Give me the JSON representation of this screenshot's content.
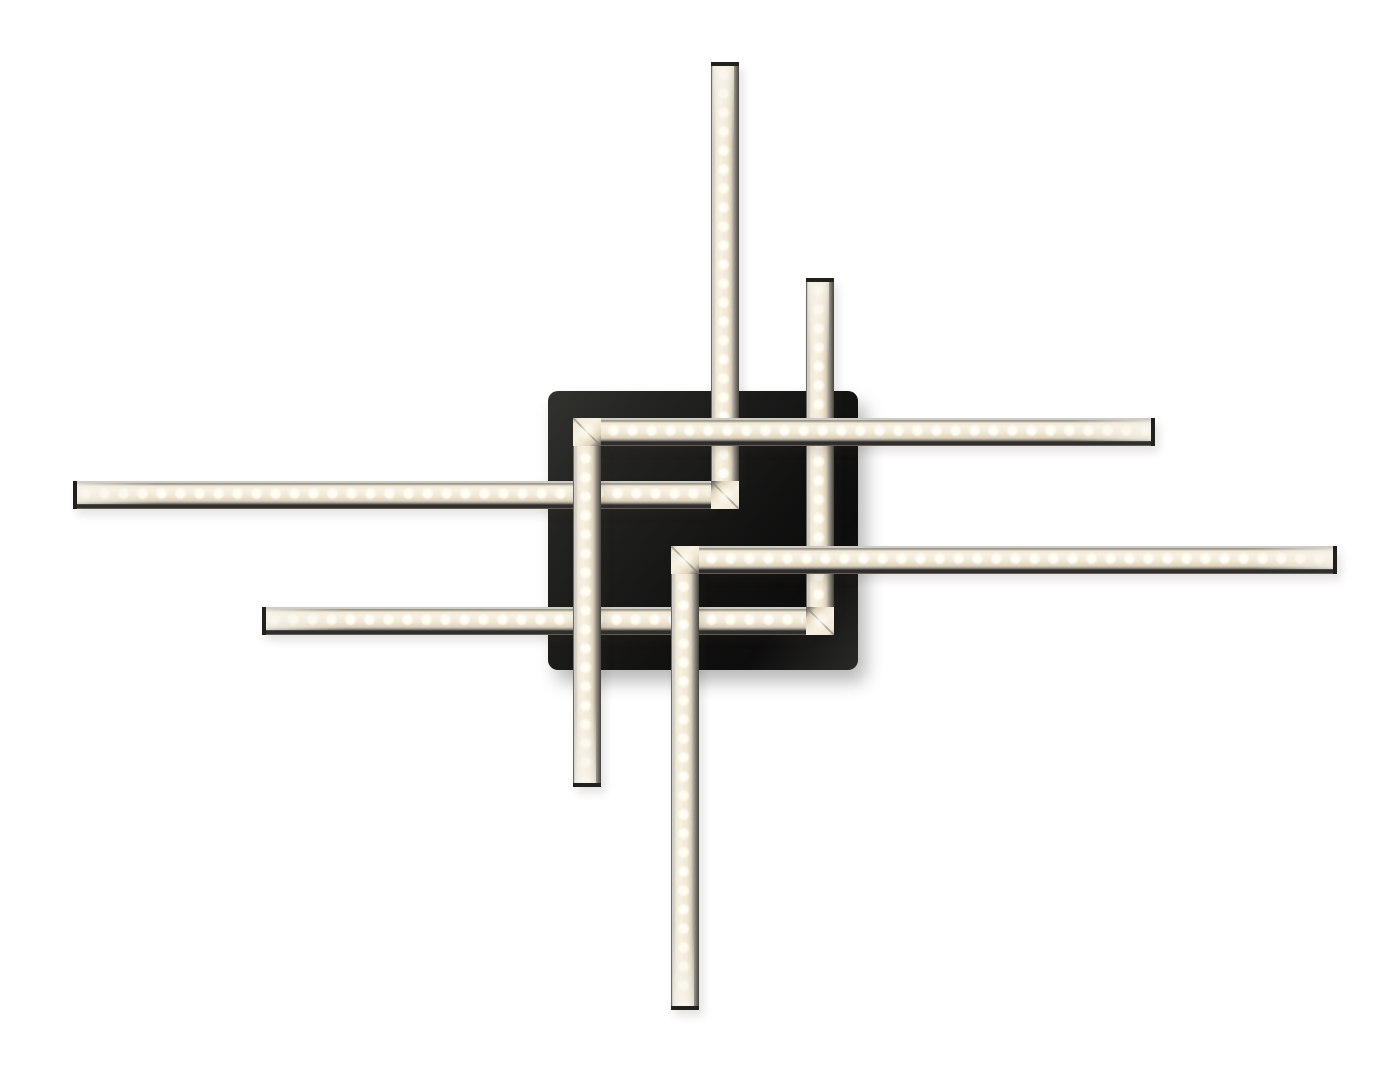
{
  "product": {
    "name": "led-ceiling-light",
    "description": "Black square canopy with four L-shaped warm-white LED light bars arranged in a windmill / pinwheel pattern on a plain white background",
    "bar_count": 4,
    "bars": [
      {
        "id": "lamp-b",
        "shape": "L",
        "corner": "bottom-right",
        "arms": [
          "long vertical arm pointing up",
          "long horizontal arm pointing left"
        ]
      },
      {
        "id": "lamp-c",
        "shape": "L",
        "corner": "bottom-right",
        "arms": [
          "short vertical arm pointing up",
          "long horizontal arm pointing left"
        ]
      },
      {
        "id": "lamp-a",
        "shape": "L",
        "corner": "top-left",
        "arms": [
          "long horizontal arm pointing right",
          "vertical arm pointing down"
        ]
      },
      {
        "id": "lamp-d",
        "shape": "L",
        "corner": "top-left",
        "arms": [
          "long horizontal arm pointing right",
          "long vertical arm pointing down"
        ]
      }
    ],
    "bar_thickness_px": 28,
    "led_dot_pitch_px": 19
  },
  "colors": {
    "bg": "#ffffff",
    "plate_a": "#32322f",
    "plate_b": "#191918",
    "plate_c": "#0d0d0d",
    "rail_silver": "#cfccc6",
    "rail_mid": "#9b978f",
    "rail_dark": "#45423c",
    "cap": "#21201d",
    "cream_hi": "#f7f1e3",
    "cream_mid": "#f1e8d5",
    "cream_dim": "#ddd1ba",
    "dot_core": "#fffdf4",
    "seam": "rgba(130,124,112,0.6)"
  }
}
